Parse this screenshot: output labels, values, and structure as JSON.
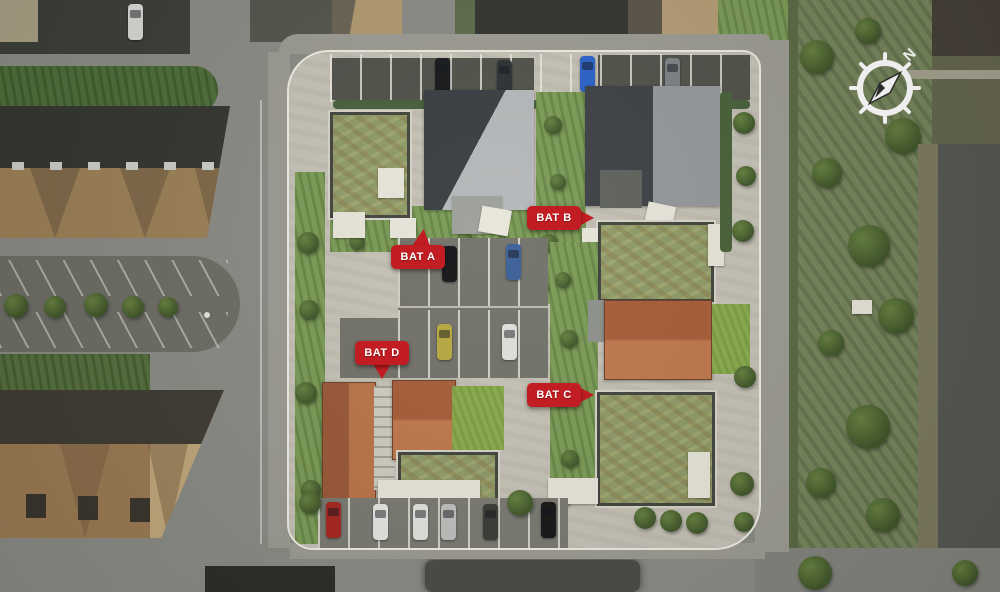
{
  "markers": {
    "bat_a": {
      "label": "BAT A"
    },
    "bat_b": {
      "label": "BAT B"
    },
    "bat_c": {
      "label": "BAT C"
    },
    "bat_d": {
      "label": "BAT D"
    }
  },
  "compass": {
    "north_label": "N"
  },
  "colors": {
    "marker_red": "#c21d22",
    "road_gray": "#8b8b86",
    "site_pavement": "#c6c2b6",
    "green_roof": "#8f9a68",
    "orange_roof": "#b06742",
    "dark_roof": "#3d4145",
    "light_roof": "#b4b7b9",
    "grass_green": "#7b9b55"
  }
}
